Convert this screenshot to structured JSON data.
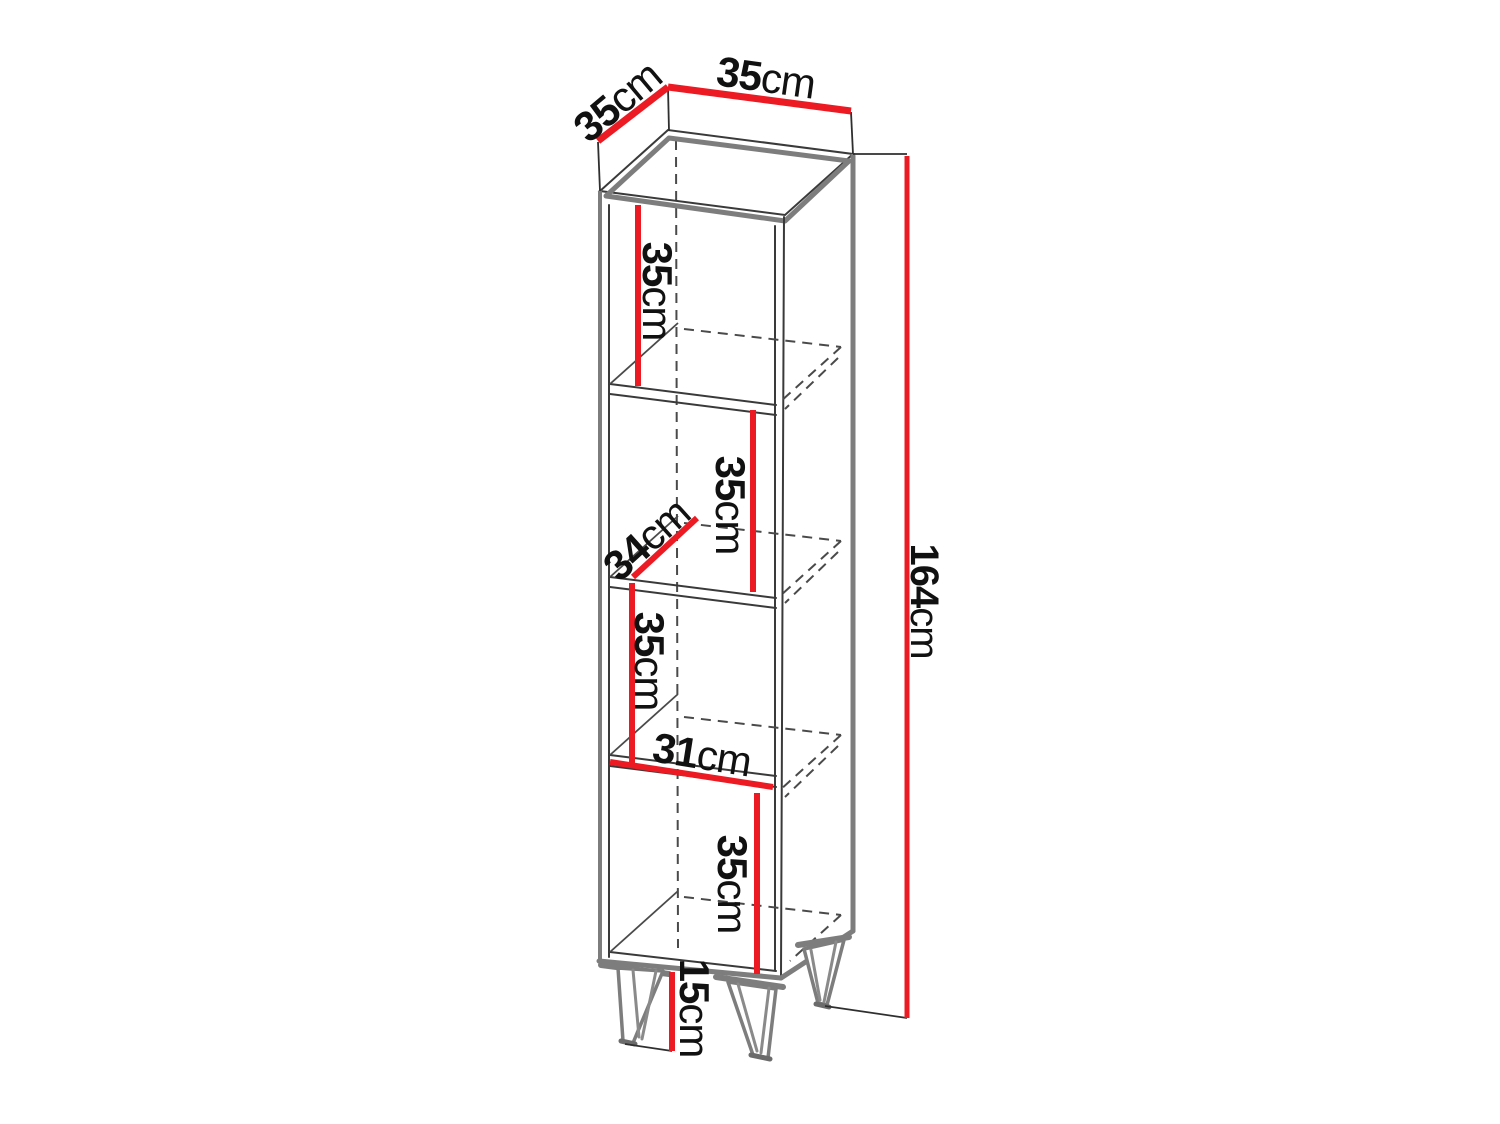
{
  "diagram": {
    "subject": "tall-open-shelf-cabinet-dimension-drawing",
    "unit": "cm",
    "colors": {
      "dimension": "#ec1b23",
      "outline": "#3a3a3a",
      "panel_edge": "#7d7d7d",
      "background": "#ffffff"
    },
    "dimensions": {
      "top_depth": {
        "value": "35",
        "unit": "cm"
      },
      "top_width": {
        "value": "35",
        "unit": "cm"
      },
      "total_height": {
        "value": "164",
        "unit": "cm"
      },
      "compartment_1_height": {
        "value": "35",
        "unit": "cm"
      },
      "compartment_2_height": {
        "value": "35",
        "unit": "cm"
      },
      "shelf_depth": {
        "value": "34",
        "unit": "cm"
      },
      "compartment_3_height": {
        "value": "35",
        "unit": "cm"
      },
      "inner_width": {
        "value": "31",
        "unit": "cm"
      },
      "compartment_4_height": {
        "value": "35",
        "unit": "cm"
      },
      "leg_height": {
        "value": "15",
        "unit": "cm"
      }
    }
  }
}
